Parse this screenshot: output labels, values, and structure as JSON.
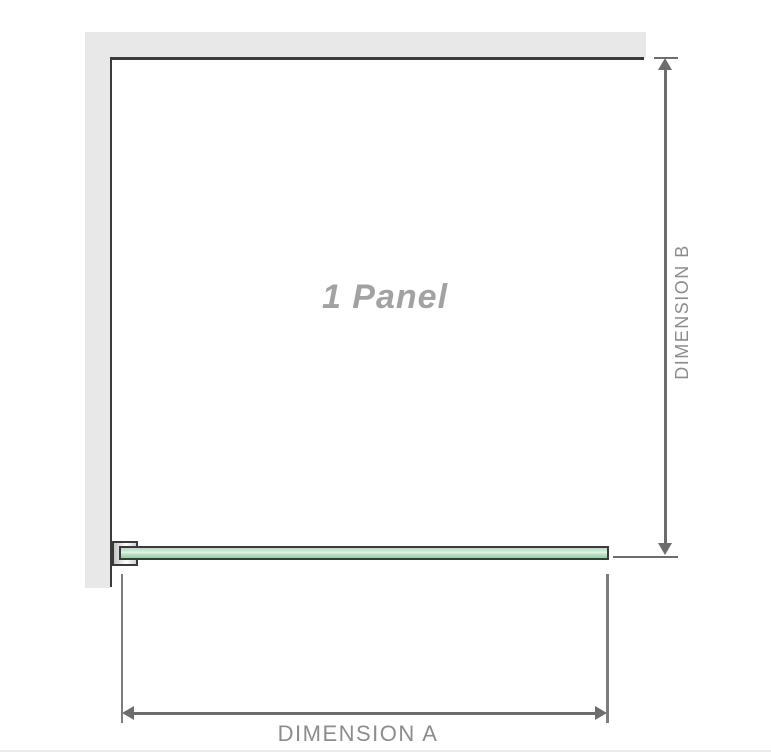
{
  "diagram": {
    "title": "shower panel dimension diagram",
    "panel_label": "1 Panel",
    "dimension_a_label": "DIMENSION A",
    "dimension_b_label": "DIMENSION B",
    "colors": {
      "wall_fill": "#e8e8e8",
      "wall_edge": "#3b3b3b",
      "glass_outline": "#3b3b3b",
      "glass_green_top": "#b4ddc0",
      "glass_green_highlight": "#e7f4e8",
      "glass_green_bottom": "#95cfa5",
      "bracket_fill": "#ffffff",
      "dimension_arrow": "#6d6d6d",
      "extension_line": "#7d7d7d",
      "label_text": "#8c8c8c",
      "panel_text": "#a2a2a2"
    }
  }
}
